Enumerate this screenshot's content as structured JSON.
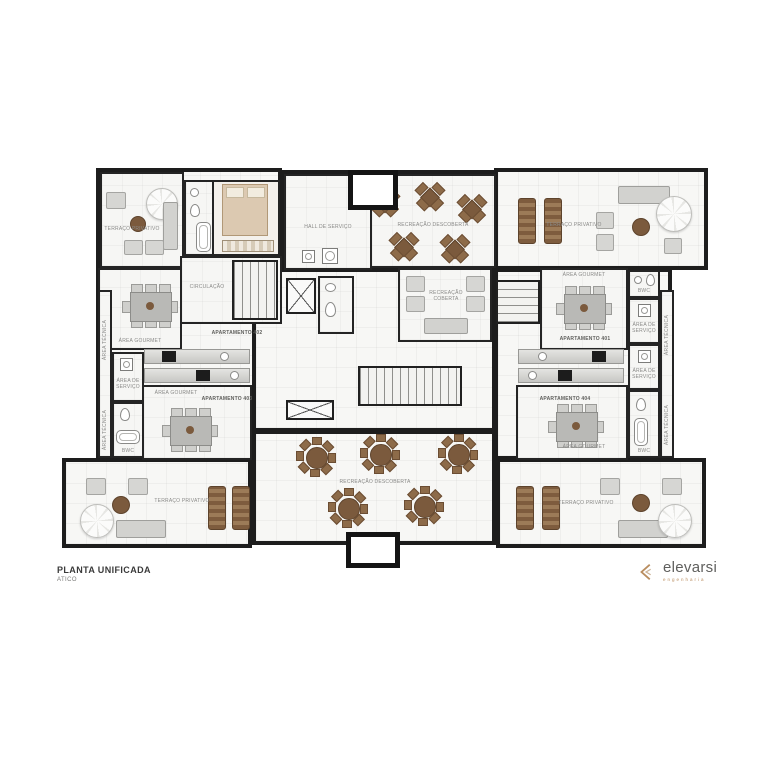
{
  "title": {
    "main": "PLANTA UNIFICADA",
    "sub": "ATICO"
  },
  "logo": {
    "brand": "elevarsi",
    "tagline": "engenharia"
  },
  "labels": {
    "terraco": "TERRAÇO PRIVATIVO",
    "gourmet": "ÁREA GOURMET",
    "apto401": "APARTAMENTO 401",
    "apto402": "APARTAMENTO 402",
    "apto403": "APARTAMENTO 403",
    "apto404": "APARTAMENTO 404",
    "recDescoberta": "RECREAÇÃO DESCOBERTA",
    "recCoberta": "RECREAÇÃO COBERTA",
    "hallServico": "HALL DE SERVIÇO",
    "circulacao": "CIRCULAÇÃO",
    "areaServico": "ÁREA DE SERVIÇO",
    "areaTecnica": "ÁREA TÉCNICA",
    "bwc": "BWC"
  },
  "colors": {
    "wall": "#1d1d1d",
    "accent": "#b98d5f",
    "wood": "#7b5a3d",
    "floor": "#f7f7f5"
  }
}
